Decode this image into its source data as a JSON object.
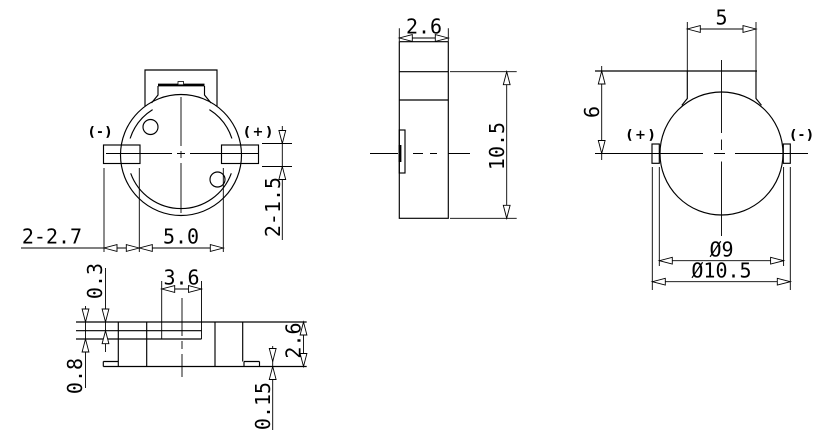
{
  "drawing": {
    "colors": {
      "line": "#000000",
      "background": "#ffffff"
    },
    "front_view": {
      "terminal_negative": "( - )",
      "terminal_positive": "( + )",
      "dim_pad_width": "2-2.7",
      "dim_pad_gap": "5.0",
      "dim_pad_thickness": "2-1.5"
    },
    "side_view": {
      "dim_width": "2.6",
      "dim_height": "10.5"
    },
    "back_view": {
      "dim_neck_width": "5",
      "dim_neck_height": "6",
      "terminal_positive": "( + )",
      "terminal_negative": "( - )",
      "dim_body_diameter": "Ø9",
      "dim_overall_diameter": "Ø10.5"
    },
    "bottom_view": {
      "dim_step": "0.3",
      "dim_slot_width": "3.6",
      "dim_base": "0.8",
      "dim_height": "2.6",
      "dim_foot": "0.15"
    }
  }
}
